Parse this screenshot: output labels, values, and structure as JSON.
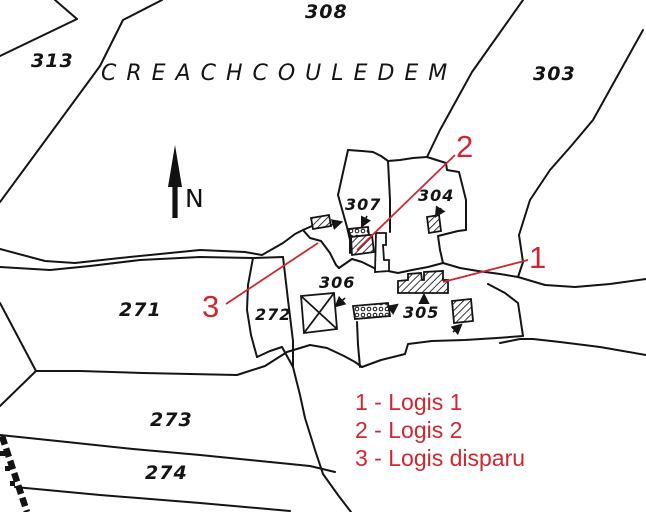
{
  "colors": {
    "ink": "#141414",
    "red": "#cf2730",
    "background": "#ffffff"
  },
  "map": {
    "place_name": "CREACHCOULEDEM",
    "north_label": "N",
    "parcels": [
      {
        "label": "308"
      },
      {
        "label": "313"
      },
      {
        "label": "303"
      },
      {
        "label": "307"
      },
      {
        "label": "304"
      },
      {
        "label": "306"
      },
      {
        "label": "305"
      },
      {
        "label": "271"
      },
      {
        "label": "272"
      },
      {
        "label": "273"
      },
      {
        "label": "274"
      }
    ],
    "markers": [
      {
        "label": "1"
      },
      {
        "label": "2"
      },
      {
        "label": "3"
      }
    ]
  },
  "legend": {
    "items": [
      {
        "text": "1 - Logis 1"
      },
      {
        "text": "2 - Logis 2"
      },
      {
        "text": "3 - Logis disparu"
      }
    ]
  }
}
